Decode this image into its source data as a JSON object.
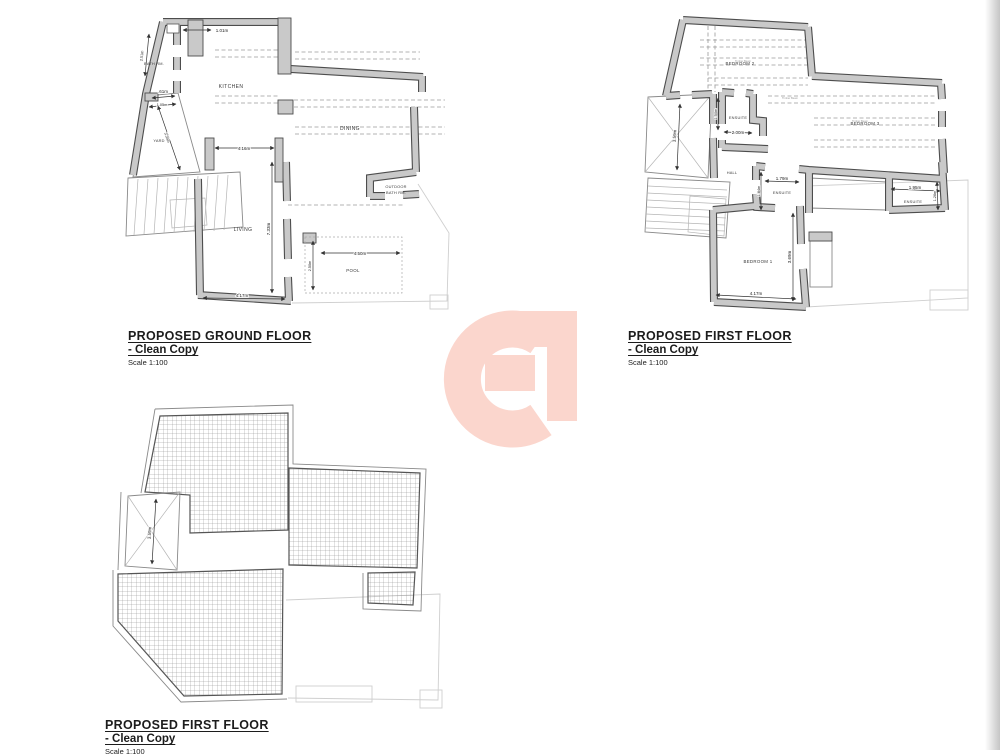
{
  "page": {
    "watermark_color": "#fbd6cd"
  },
  "plans": {
    "ground": {
      "title": "PROPOSED GROUND FLOOR",
      "subtitle": "- Clean Copy",
      "scale": "Scale 1:100",
      "rooms": {
        "bath": "BATH RM.",
        "kitchen": "KITCHEN",
        "dining": "DINING",
        "yard": "YARD",
        "living": "LIVING",
        "outdoor_bath_line1": "OUTDOOR",
        "outdoor_bath_line2": "BATH RM.",
        "pool": "POOL"
      },
      "dims": {
        "entry_width": "1.01m",
        "bath_height": "2.51m",
        "door_width": ".61m",
        "yard_width": "1.05m",
        "yard_length": "3.35m",
        "kitchen_opening": "4.16m",
        "living_length": "7.33m",
        "living_width": "4.17m",
        "pool_length": "4.50m",
        "pool_width": "2.50m"
      }
    },
    "first": {
      "title": "PROPOSED FIRST FLOOR",
      "subtitle": "- Clean Copy",
      "scale": "Scale 1:100",
      "beam_note": "Timber Beam",
      "rooms": {
        "bedroom2": "BEDROOM 2",
        "bedroom3": "BEDROOM 3",
        "ensuite2": "ENSUITE",
        "ensuite_mid": "ENSUITE",
        "ensuite_right": "ENSUITE",
        "hall": "HALL",
        "bedroom1": "BEDROOM 1"
      },
      "dims": {
        "shaft_height": "3.59m",
        "ensuite2_width": "2.00m",
        "ensuite2_height": "1.50m",
        "ensuite_mid_width": "1.79m",
        "ensuite_mid_height": "1.84m",
        "ensuite_right_width": "1.95m",
        "ensuite_right_height": "1.26m",
        "bedroom1_height": "3.69m",
        "bedroom1_width": "4.17m"
      }
    },
    "roof": {
      "title": "PROPOSED FIRST FLOOR",
      "subtitle": "- Clean Copy",
      "scale": "Scale 1:100",
      "dims": {
        "shaft_height": "3.59m"
      }
    }
  }
}
